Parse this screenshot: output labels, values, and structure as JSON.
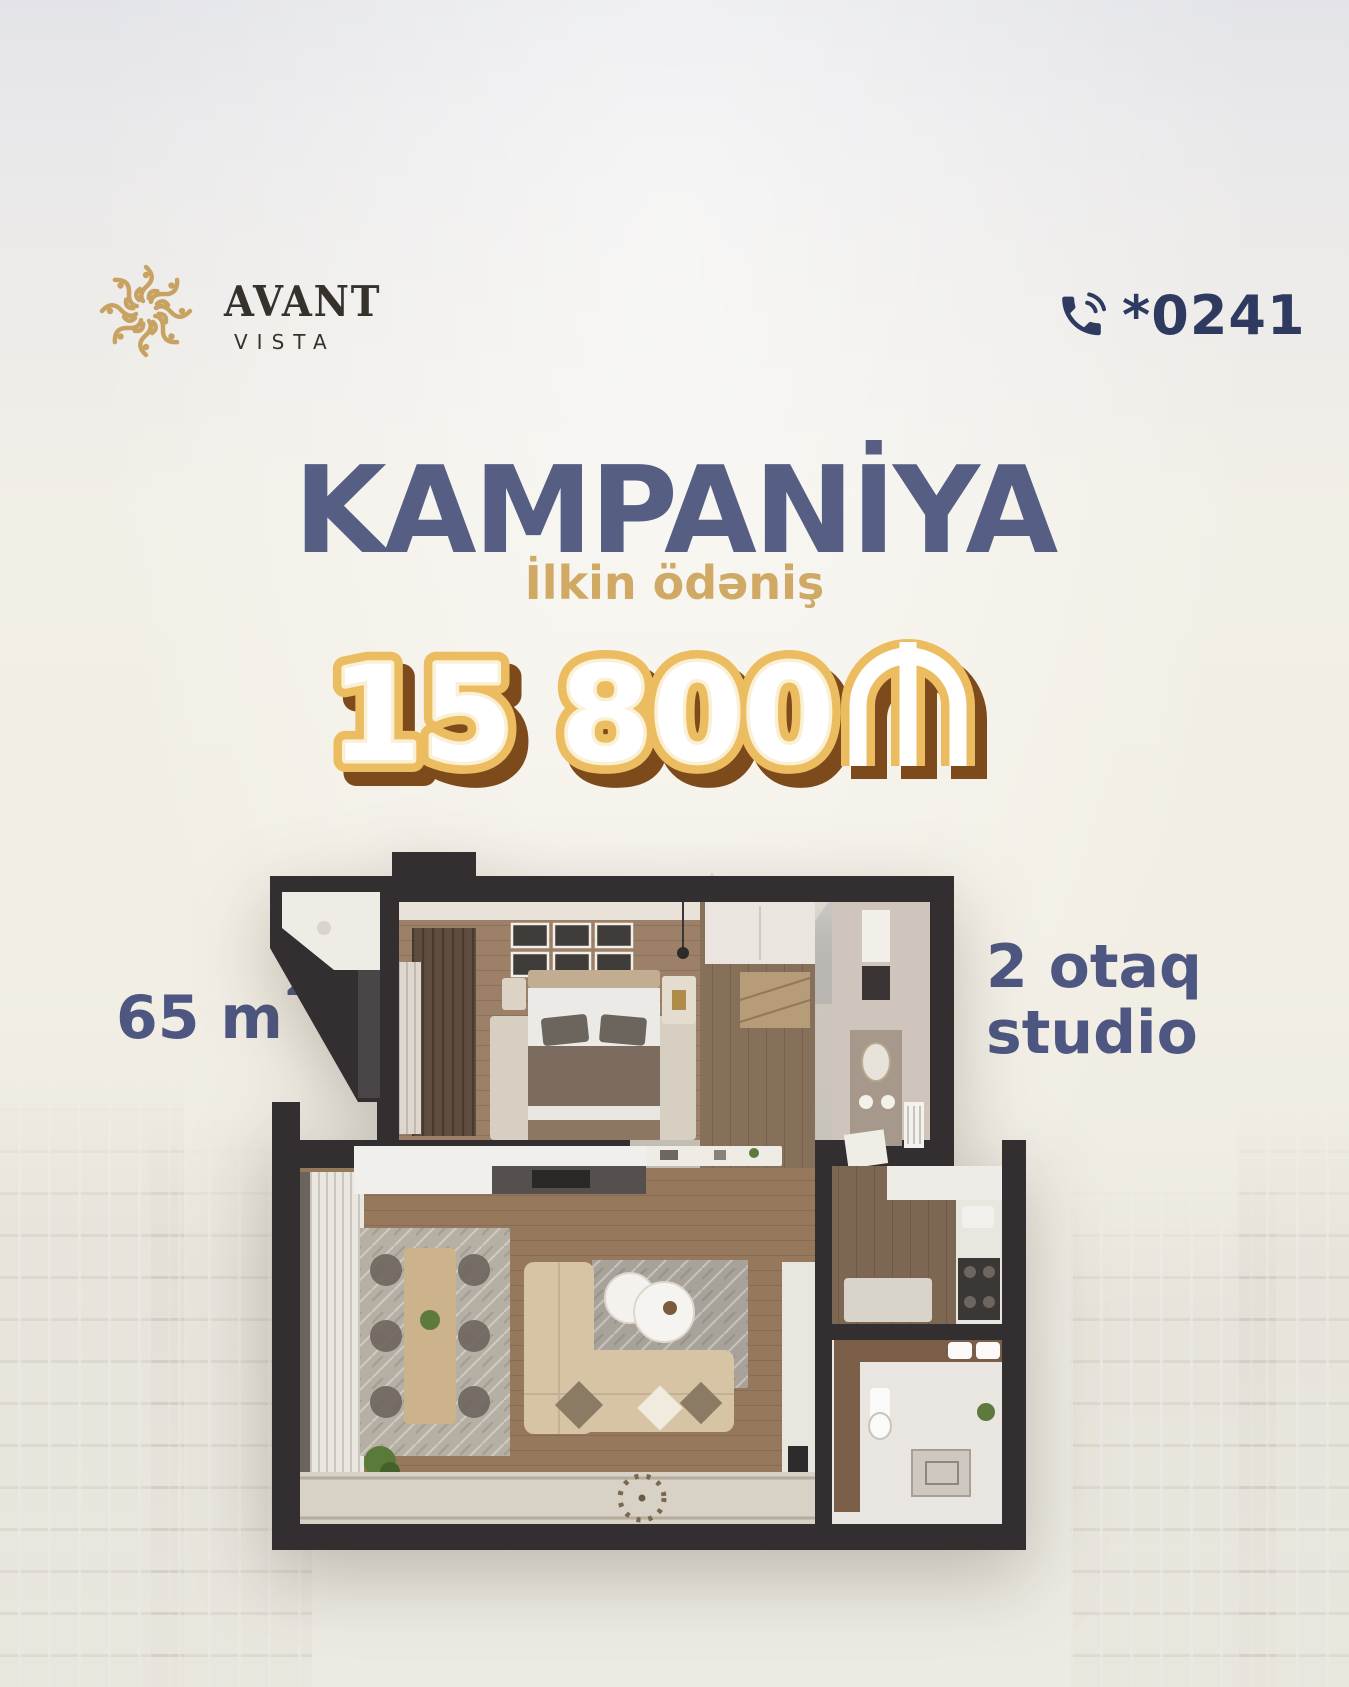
{
  "brand": {
    "name_line1": "AVANT",
    "name_line2": "VISTA"
  },
  "contact": {
    "phone": "*0241"
  },
  "campaign": {
    "title": "KAMPANİYA",
    "subtitle": "İlkin ödəniş",
    "price": "15 800",
    "currency_symbol": "₼"
  },
  "apartment": {
    "area": "65 m",
    "area_sup": "2",
    "type_line1": "2 otaq",
    "type_line2": "studio"
  },
  "colors": {
    "title_navy": "#565e84",
    "label_navy": "#4d5781",
    "phone_navy": "#2e3a5f",
    "gold": "#d0aa65",
    "logo_gold": "#c7a263",
    "price_outline_gold": "#ecbd60",
    "price_shadow_brown": "#7d4b1b",
    "plan_wall": "#332f30"
  }
}
